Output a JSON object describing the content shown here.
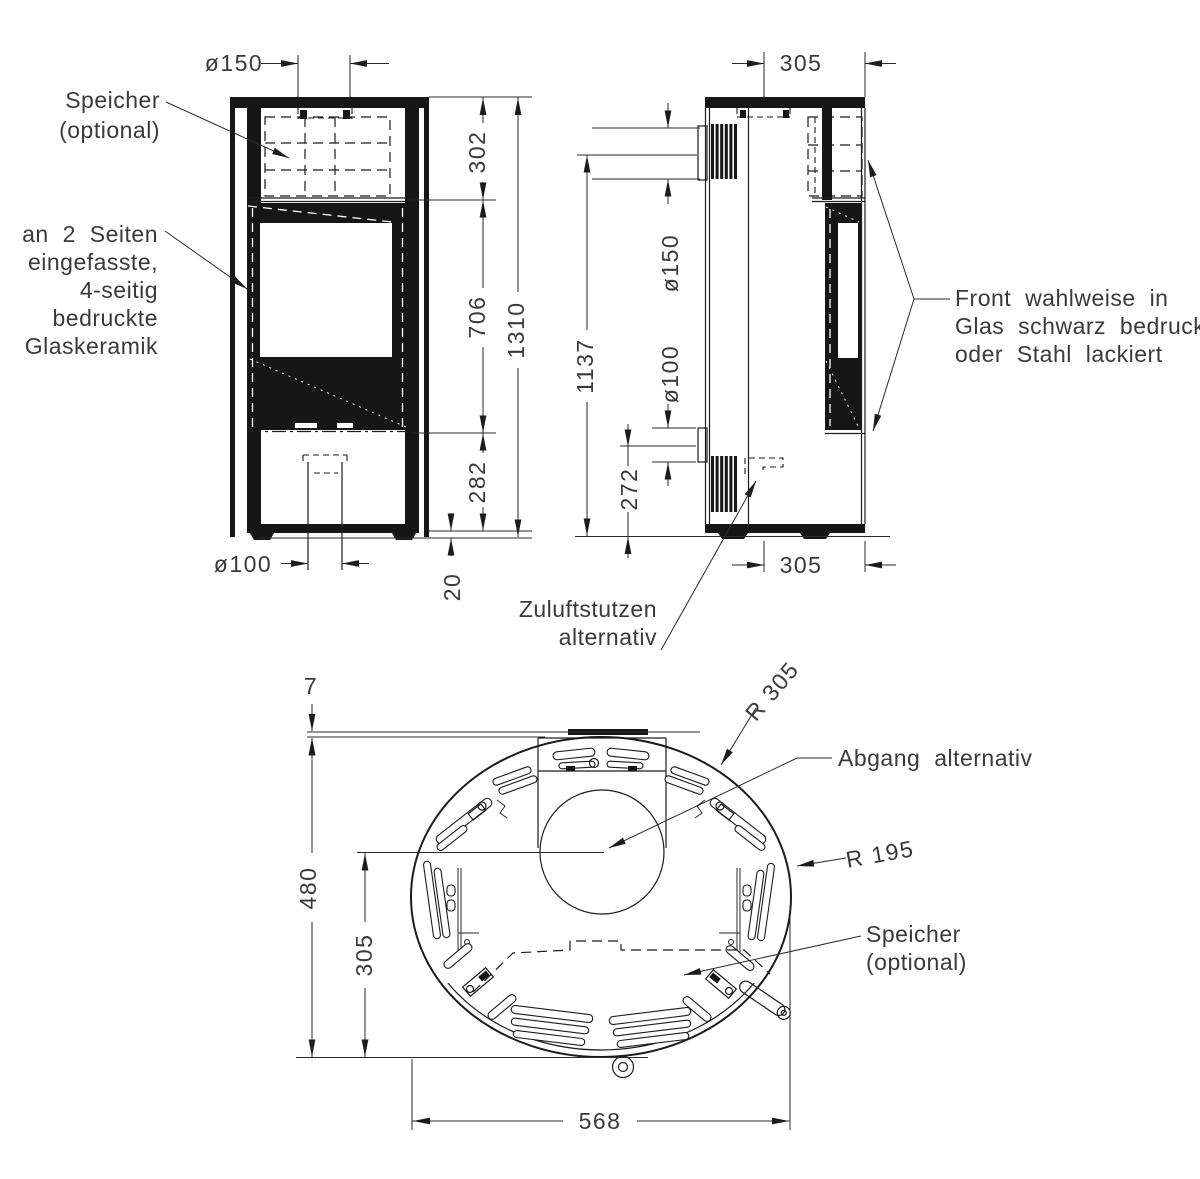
{
  "colors": {
    "line": "#1c1c1c",
    "text": "#3a3a3a",
    "background": "#ffffff"
  },
  "front": {
    "dim_flue_diameter": "ø150",
    "dim_upper": "302",
    "dim_window": "706",
    "dim_total": "1310",
    "dim_lower": "282",
    "dim_foot_gap": "20",
    "dim_pipe_diameter": "ø100",
    "label_speicher": [
      "Speicher",
      "(optional)"
    ],
    "label_glass": [
      "an 2 Seiten",
      "eingefasste,",
      "4-seitig",
      "bedruckte",
      "Glaskeramik"
    ]
  },
  "side": {
    "dim_depth_top": "305",
    "dim_flue_diameter": "ø150",
    "dim_flue_height": "1137",
    "dim_inlet_diameter": "ø100",
    "dim_inlet_height": "272",
    "dim_depth_bottom": "305",
    "label_front": [
      "Front wahlweise in",
      "Glas schwarz bedruckt",
      "oder Stahl lackiert"
    ],
    "label_zuluft": [
      "Zuluftstutzen",
      "alternativ"
    ]
  },
  "plan": {
    "dim_gap": "7",
    "dim_depth": "480",
    "dim_flue_to_front": "305",
    "dim_width": "568",
    "dim_radius_outer": "R 305",
    "dim_radius_inner": "R 195",
    "label_abgang": "Abgang alternativ",
    "label_speicher": [
      "Speicher",
      "(optional)"
    ]
  }
}
